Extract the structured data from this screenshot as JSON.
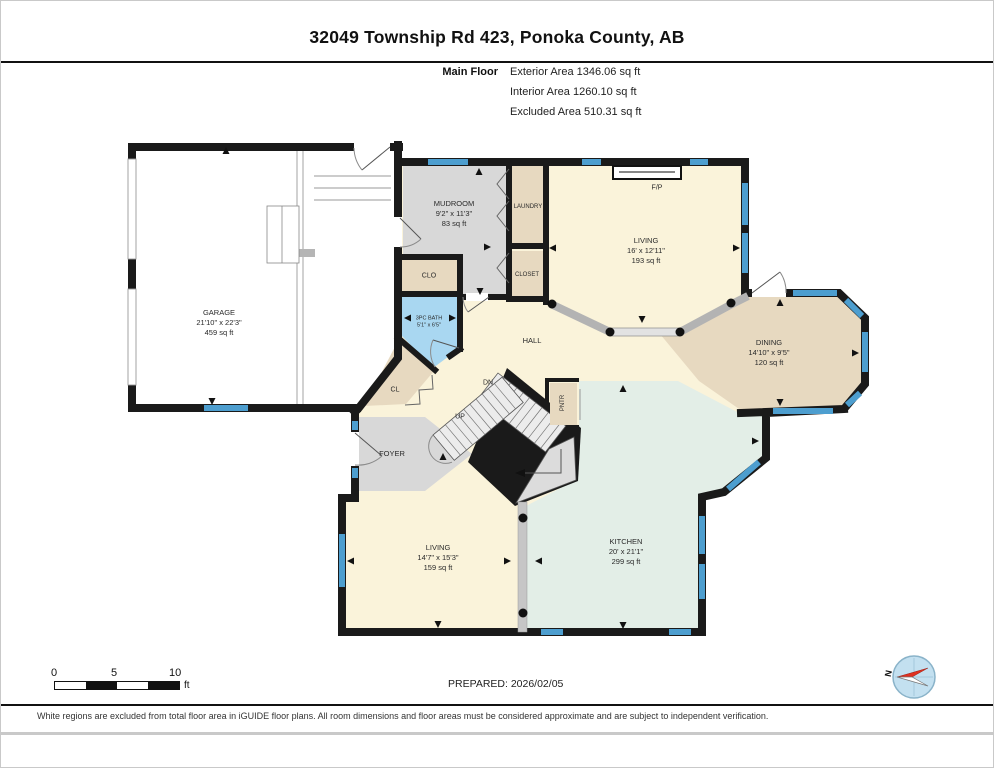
{
  "page": {
    "title": "32049 Township Rd 423, Ponoka County, AB",
    "floor_label": "Main Floor",
    "stats": [
      "Exterior Area 1346.06 sq ft",
      "Interior Area 1260.10 sq ft",
      "Excluded Area 510.31 sq ft"
    ],
    "prepared": "PREPARED: 2026/02/05",
    "disclaimer": "White regions are excluded from total floor area in iGUIDE floor plans. All room dimensions and floor areas must be considered approximate and are subject to independent verification.",
    "compass_label": "N",
    "scale": {
      "t0": "0",
      "t5": "5",
      "t10": "10",
      "unit": "ft"
    }
  },
  "palette": {
    "wall": "#1a1a1a",
    "window": "#4d9ecf",
    "cream": "#faf3da",
    "tan": "#e7d9c0",
    "gray": "#d8d8d8",
    "bath": "#a9d7f1",
    "mint": "#e3eee7",
    "garage": "#ffffff"
  },
  "rooms": [
    {
      "id": "garage",
      "name": "GARAGE",
      "dims": "21'10\" x 22'3\"",
      "area": "459 sq ft",
      "x": 218,
      "y": 322,
      "fs": 7.5
    },
    {
      "id": "mudroom",
      "name": "MUDROOM",
      "dims": "9'2\" x 11'3\"",
      "area": "83 sq ft",
      "x": 453,
      "y": 213,
      "fs": 7.5
    },
    {
      "id": "laundry",
      "name": "LAUNDRY",
      "x": 527,
      "y": 206,
      "fs": 6
    },
    {
      "id": "closet",
      "name": "CLOSET",
      "x": 526,
      "y": 274,
      "fs": 6
    },
    {
      "id": "clo",
      "name": "CLO",
      "x": 428,
      "y": 275,
      "fs": 7
    },
    {
      "id": "bath",
      "name": "3PC BATH",
      "dims": "5'1\" x 6'5\"",
      "x": 428,
      "y": 322,
      "fs": 5.5
    },
    {
      "id": "living-main",
      "name": "LIVING",
      "dims": "16' x 12'11\"",
      "area": "193 sq ft",
      "x": 645,
      "y": 250,
      "fs": 7.5
    },
    {
      "id": "dining",
      "name": "DINING",
      "dims": "14'10\" x 9'5\"",
      "area": "120 sq ft",
      "x": 768,
      "y": 352,
      "fs": 7.5
    },
    {
      "id": "hall",
      "name": "HALL",
      "x": 531,
      "y": 340,
      "fs": 7.5
    },
    {
      "id": "cl",
      "name": "CL",
      "x": 394,
      "y": 389,
      "fs": 7
    },
    {
      "id": "dn",
      "name": "DN",
      "x": 487,
      "y": 382,
      "fs": 7
    },
    {
      "id": "up",
      "name": "UP",
      "x": 459,
      "y": 416,
      "fs": 7
    },
    {
      "id": "pntr",
      "name": "PNTR",
      "x": 562,
      "y": 402,
      "fs": 6,
      "vertical": true
    },
    {
      "id": "foyer",
      "name": "FOYER",
      "x": 391,
      "y": 453,
      "fs": 7.5
    },
    {
      "id": "living-front",
      "name": "LIVING",
      "dims": "14'7\" x 15'3\"",
      "area": "159 sq ft",
      "x": 437,
      "y": 557,
      "fs": 7.5
    },
    {
      "id": "kitchen",
      "name": "KITCHEN",
      "dims": "20' x 21'1\"",
      "area": "299 sq ft",
      "x": 625,
      "y": 551,
      "fs": 7.5
    },
    {
      "id": "fp",
      "name": "F/P",
      "x": 656,
      "y": 187,
      "fs": 7
    }
  ]
}
